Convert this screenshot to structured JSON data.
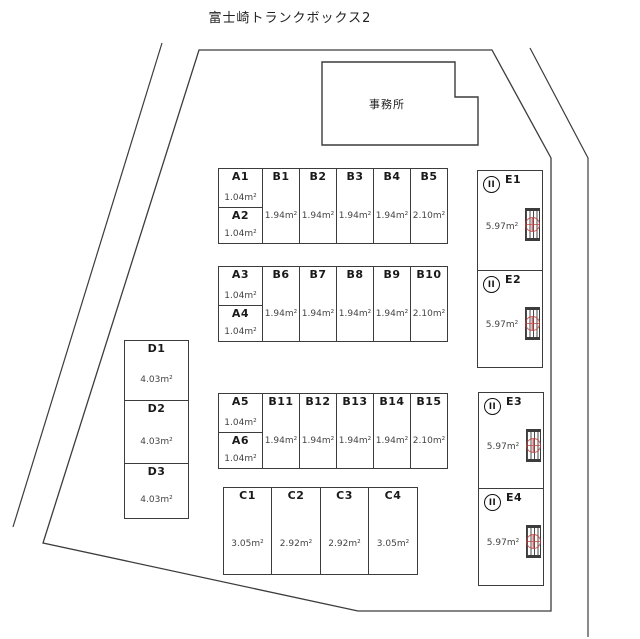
{
  "title": "富士崎トランクボックス2",
  "office_label": "事務所",
  "units": {
    "rows_ab": [
      {
        "a": [
          {
            "id": "A1",
            "area": "1.04㎡"
          },
          {
            "id": "A2",
            "area": "1.04㎡"
          }
        ],
        "b": [
          {
            "id": "B1",
            "area": "1.94㎡"
          },
          {
            "id": "B2",
            "area": "1.94㎡"
          },
          {
            "id": "B3",
            "area": "1.94㎡"
          },
          {
            "id": "B4",
            "area": "1.94㎡"
          },
          {
            "id": "B5",
            "area": "2.10㎡"
          }
        ]
      },
      {
        "a": [
          {
            "id": "A3",
            "area": "1.04㎡"
          },
          {
            "id": "A4",
            "area": "1.04㎡"
          }
        ],
        "b": [
          {
            "id": "B6",
            "area": "1.94㎡"
          },
          {
            "id": "B7",
            "area": "1.94㎡"
          },
          {
            "id": "B8",
            "area": "1.94㎡"
          },
          {
            "id": "B9",
            "area": "1.94㎡"
          },
          {
            "id": "B10",
            "area": "2.10㎡"
          }
        ]
      },
      {
        "a": [
          {
            "id": "A5",
            "area": "1.04㎡"
          },
          {
            "id": "A6",
            "area": "1.04㎡"
          }
        ],
        "b": [
          {
            "id": "B11",
            "area": "1.94㎡"
          },
          {
            "id": "B12",
            "area": "1.94㎡"
          },
          {
            "id": "B13",
            "area": "1.94㎡"
          },
          {
            "id": "B14",
            "area": "1.94㎡"
          },
          {
            "id": "B15",
            "area": "2.10㎡"
          }
        ]
      }
    ],
    "c": [
      {
        "id": "C1",
        "area": "3.05㎡"
      },
      {
        "id": "C2",
        "area": "2.92㎡"
      },
      {
        "id": "C3",
        "area": "2.92㎡"
      },
      {
        "id": "C4",
        "area": "3.05㎡"
      }
    ],
    "d": [
      {
        "id": "D1",
        "area": "4.03㎡"
      },
      {
        "id": "D2",
        "area": "4.03㎡"
      },
      {
        "id": "D3",
        "area": "4.03㎡"
      }
    ],
    "e": [
      {
        "id": "E1",
        "area": "5.97㎡"
      },
      {
        "id": "E2",
        "area": "5.97㎡"
      },
      {
        "id": "E3",
        "area": "5.97㎡"
      },
      {
        "id": "E4",
        "area": "5.97㎡"
      }
    ],
    "e_circle_mark": "II"
  },
  "colors": {
    "line": "#3c3c3c",
    "stamp": "#c23b3b",
    "label": "#1a1a1a",
    "area_text": "#444444"
  }
}
